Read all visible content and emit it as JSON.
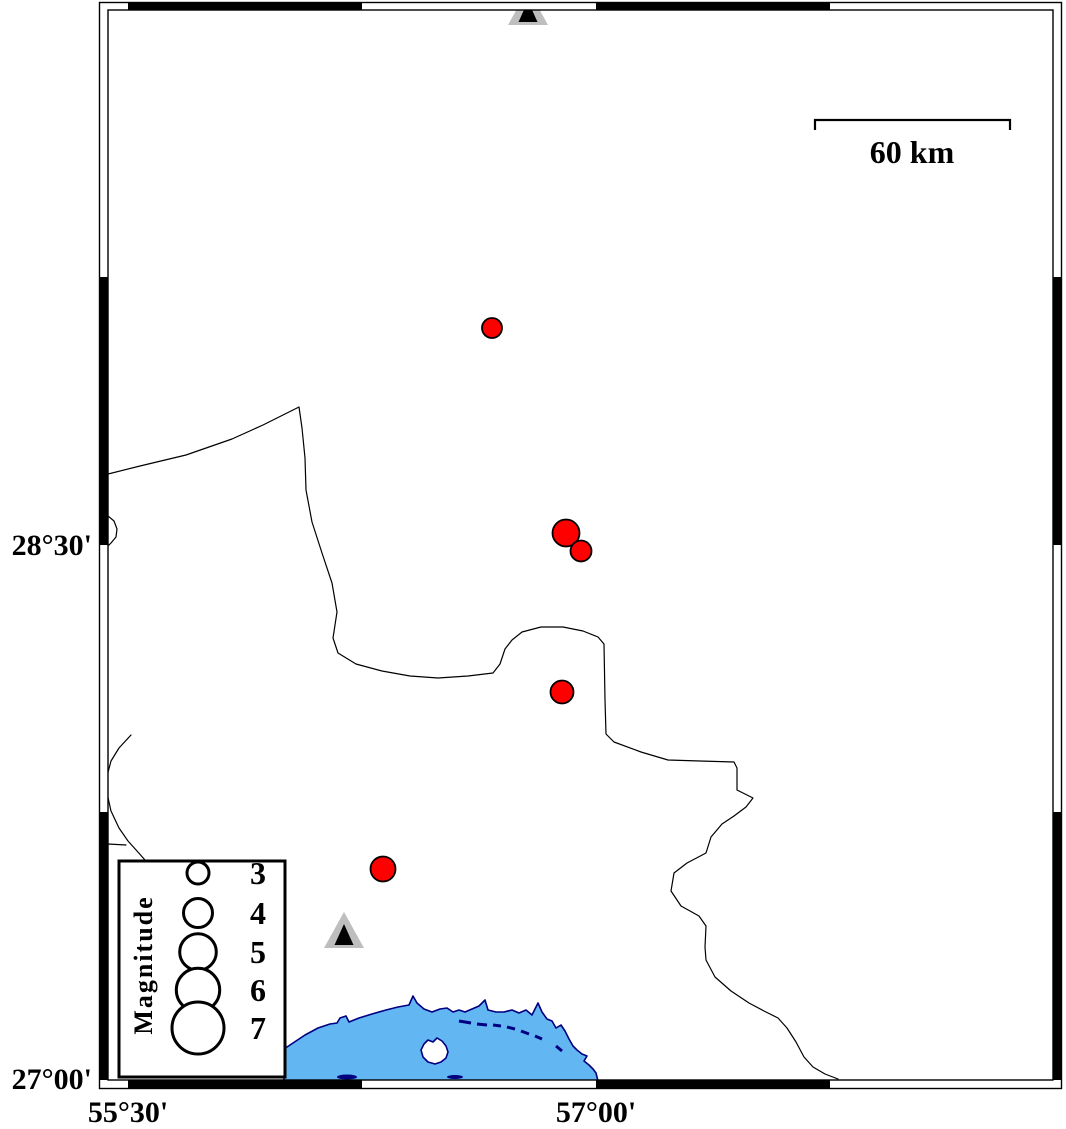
{
  "figure": {
    "type": "seismicity-map",
    "axis": {
      "left_labels": [
        {
          "text": "28°30'",
          "y": 545
        },
        {
          "text": "27°00'",
          "y": 1080
        }
      ],
      "bottom_labels": [
        {
          "text": "55°30'",
          "x": 128
        },
        {
          "text": "57°00'",
          "x": 596
        }
      ]
    },
    "scale_bar": {
      "label": "60 km",
      "x1": 815,
      "x2": 1010,
      "y": 120,
      "tick": 10
    },
    "legend": {
      "title": "Magnitude",
      "entries": [
        {
          "label": "3",
          "r": 11
        },
        {
          "label": "4",
          "r": 14.5
        },
        {
          "label": "5",
          "r": 18.3
        },
        {
          "label": "6",
          "r": 21.7
        },
        {
          "label": "7",
          "r": 26
        }
      ],
      "box": {
        "x": 119,
        "y": 861,
        "w": 166,
        "h": 216
      },
      "circle_cx": 198,
      "label_x": 258,
      "row_ys": [
        873,
        913,
        952,
        990,
        1028
      ],
      "title_x": 143,
      "title_y": 974
    },
    "earthquakes": [
      {
        "x": 492,
        "y": 328,
        "r": 10
      },
      {
        "x": 566,
        "y": 533,
        "r": 13.5
      },
      {
        "x": 581,
        "y": 551,
        "r": 10.5
      },
      {
        "x": 562,
        "y": 692,
        "r": 11.5
      },
      {
        "x": 383,
        "y": 869,
        "r": 12.5
      }
    ],
    "stations": [
      {
        "x": 528,
        "base_y": 25
      },
      {
        "x": 344,
        "base_y": 948
      }
    ],
    "boundaries": [
      [
        [
          108,
          474
        ],
        [
          140,
          466
        ],
        [
          186,
          455
        ],
        [
          232,
          439
        ],
        [
          263,
          425
        ],
        [
          289,
          412
        ],
        [
          299,
          407
        ],
        [
          302,
          428
        ],
        [
          305,
          458
        ],
        [
          306,
          490
        ],
        [
          312,
          522
        ],
        [
          322,
          553
        ],
        [
          332,
          583
        ],
        [
          337,
          612
        ],
        [
          333,
          638
        ],
        [
          338,
          653
        ],
        [
          356,
          664
        ],
        [
          382,
          671
        ],
        [
          410,
          676
        ],
        [
          438,
          678
        ],
        [
          468,
          676
        ],
        [
          493,
          673
        ],
        [
          500,
          664
        ],
        [
          505,
          649
        ],
        [
          512,
          640
        ],
        [
          522,
          632
        ],
        [
          541,
          627
        ],
        [
          563,
          627
        ],
        [
          583,
          631
        ],
        [
          598,
          637
        ],
        [
          604,
          644
        ],
        [
          605,
          700
        ],
        [
          606,
          734
        ],
        [
          614,
          742
        ],
        [
          641,
          752
        ],
        [
          668,
          760
        ],
        [
          700,
          761
        ],
        [
          734,
          762
        ],
        [
          737,
          768
        ],
        [
          737,
          790
        ],
        [
          745,
          794
        ],
        [
          753,
          798
        ],
        [
          746,
          807
        ],
        [
          734,
          816
        ],
        [
          722,
          824
        ],
        [
          711,
          837
        ],
        [
          706,
          853
        ],
        [
          687,
          863
        ],
        [
          674,
          873
        ],
        [
          671,
          891
        ],
        [
          681,
          906
        ],
        [
          699,
          916
        ],
        [
          706,
          926
        ],
        [
          705,
          947
        ],
        [
          706,
          960
        ],
        [
          715,
          977
        ],
        [
          731,
          991
        ],
        [
          749,
          1003
        ],
        [
          764,
          1011
        ],
        [
          778,
          1018
        ],
        [
          787,
          1028
        ],
        [
          796,
          1042
        ],
        [
          804,
          1057
        ],
        [
          813,
          1067
        ],
        [
          825,
          1074
        ],
        [
          838,
          1079
        ]
      ],
      [
        [
          131,
          735
        ],
        [
          119,
          748
        ],
        [
          111,
          761
        ],
        [
          107,
          776
        ],
        [
          107,
          793
        ],
        [
          111,
          811
        ],
        [
          119,
          828
        ],
        [
          128,
          841
        ],
        [
          137,
          851
        ],
        [
          145,
          860
        ]
      ],
      [
        [
          108,
          844
        ],
        [
          126,
          845
        ]
      ],
      [
        [
          108,
          516
        ],
        [
          114,
          521
        ],
        [
          117,
          529
        ],
        [
          116,
          537
        ],
        [
          111,
          543
        ],
        [
          108,
          546
        ]
      ]
    ],
    "coast": {
      "sea_polygon": [
        [
          284,
          1049
        ],
        [
          293,
          1043
        ],
        [
          305,
          1035
        ],
        [
          318,
          1028
        ],
        [
          330,
          1024
        ],
        [
          337,
          1023
        ],
        [
          340,
          1018
        ],
        [
          346,
          1016
        ],
        [
          349,
          1022
        ],
        [
          359,
          1018
        ],
        [
          372,
          1014
        ],
        [
          386,
          1010
        ],
        [
          398,
          1007
        ],
        [
          409,
          1005
        ],
        [
          413,
          996
        ],
        [
          417,
          1003
        ],
        [
          424,
          1009
        ],
        [
          432,
          1012
        ],
        [
          440,
          1009
        ],
        [
          447,
          1008
        ],
        [
          453,
          1012
        ],
        [
          459,
          1010
        ],
        [
          465,
          1012
        ],
        [
          472,
          1009
        ],
        [
          479,
          1006
        ],
        [
          485,
          1000
        ],
        [
          488,
          1010
        ],
        [
          496,
          1012
        ],
        [
          504,
          1012
        ],
        [
          512,
          1010
        ],
        [
          519,
          1013
        ],
        [
          526,
          1010
        ],
        [
          532,
          1015
        ],
        [
          538,
          1003
        ],
        [
          542,
          1012
        ],
        [
          547,
          1019
        ],
        [
          552,
          1021
        ],
        [
          556,
          1028
        ],
        [
          561,
          1025
        ],
        [
          565,
          1031
        ],
        [
          569,
          1039
        ],
        [
          573,
          1046
        ],
        [
          577,
          1050
        ],
        [
          582,
          1054
        ],
        [
          587,
          1056
        ],
        [
          584,
          1061
        ],
        [
          589,
          1065
        ],
        [
          593,
          1069
        ],
        [
          596,
          1073
        ],
        [
          598,
          1081
        ],
        [
          284,
          1081
        ]
      ],
      "island": [
        [
          424,
          1044
        ],
        [
          428,
          1040
        ],
        [
          433,
          1042
        ],
        [
          437,
          1038
        ],
        [
          442,
          1041
        ],
        [
          446,
          1046
        ],
        [
          448,
          1052
        ],
        [
          446,
          1058
        ],
        [
          441,
          1062
        ],
        [
          435,
          1064
        ],
        [
          428,
          1062
        ],
        [
          423,
          1057
        ],
        [
          421,
          1050
        ]
      ],
      "dashes": [
        [
          459,
          1021,
          471,
          1023
        ],
        [
          477,
          1024,
          487,
          1025
        ],
        [
          493,
          1025,
          501,
          1026
        ],
        [
          507,
          1027,
          515,
          1029
        ],
        [
          521,
          1031,
          529,
          1034
        ],
        [
          535,
          1036,
          542,
          1039
        ],
        [
          556,
          1046,
          562,
          1051
        ]
      ],
      "islets": [
        [
          347,
          1077,
          10,
          2.5
        ],
        [
          455,
          1077,
          8,
          2
        ]
      ]
    },
    "frame": {
      "outer": [
        99.5,
        2.5,
        962,
        1086
      ],
      "inner": [
        108,
        10,
        945,
        1070
      ],
      "black_x": [
        [
          128,
          362
        ],
        [
          596,
          830
        ]
      ],
      "black_y": [
        [
          277,
          545
        ],
        [
          812,
          1080
        ]
      ]
    },
    "colors": {
      "sea": "#62B6F2",
      "coast": "#000080",
      "quake": "#FF0000",
      "station_gray": "#BEBEBE",
      "black": "#000000"
    }
  }
}
